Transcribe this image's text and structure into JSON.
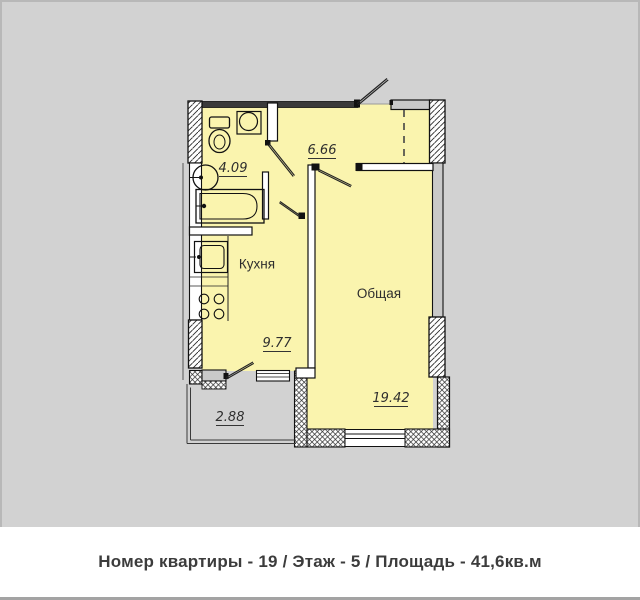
{
  "plan": {
    "rooms": [
      {
        "id": "bathroom",
        "area_label": "4.09"
      },
      {
        "id": "hallway",
        "area_label": "6.66"
      },
      {
        "id": "kitchen",
        "name": "Кухня",
        "area_label": "9.77"
      },
      {
        "id": "living-room",
        "name": "Общая",
        "area_label": "19.42"
      },
      {
        "id": "balcony",
        "area_label": "2.88"
      }
    ],
    "fixtures": [
      "toilet",
      "washbasin",
      "round-washbasin",
      "bathtub",
      "kitchen-sink",
      "stove"
    ],
    "doors": [
      "entrance-door",
      "bathroom-door",
      "kitchen-door",
      "living-room-door",
      "balcony-door"
    ],
    "windows": [
      "left-window",
      "balcony-window",
      "south-window"
    ]
  },
  "footer": {
    "text": "Номер квартиры - 19 / Этаж - 5 / Площадь - 41,6кв.м"
  },
  "colors": {
    "background": "#d2d2d2",
    "floor_fill": "#faf4ae",
    "wall_dark": "#3a3a3a",
    "panel_gray": "#c9c9c9",
    "label_text": "#2e2e2e",
    "footer_bg": "#ffffff",
    "footer_text": "#3c3c3c"
  }
}
